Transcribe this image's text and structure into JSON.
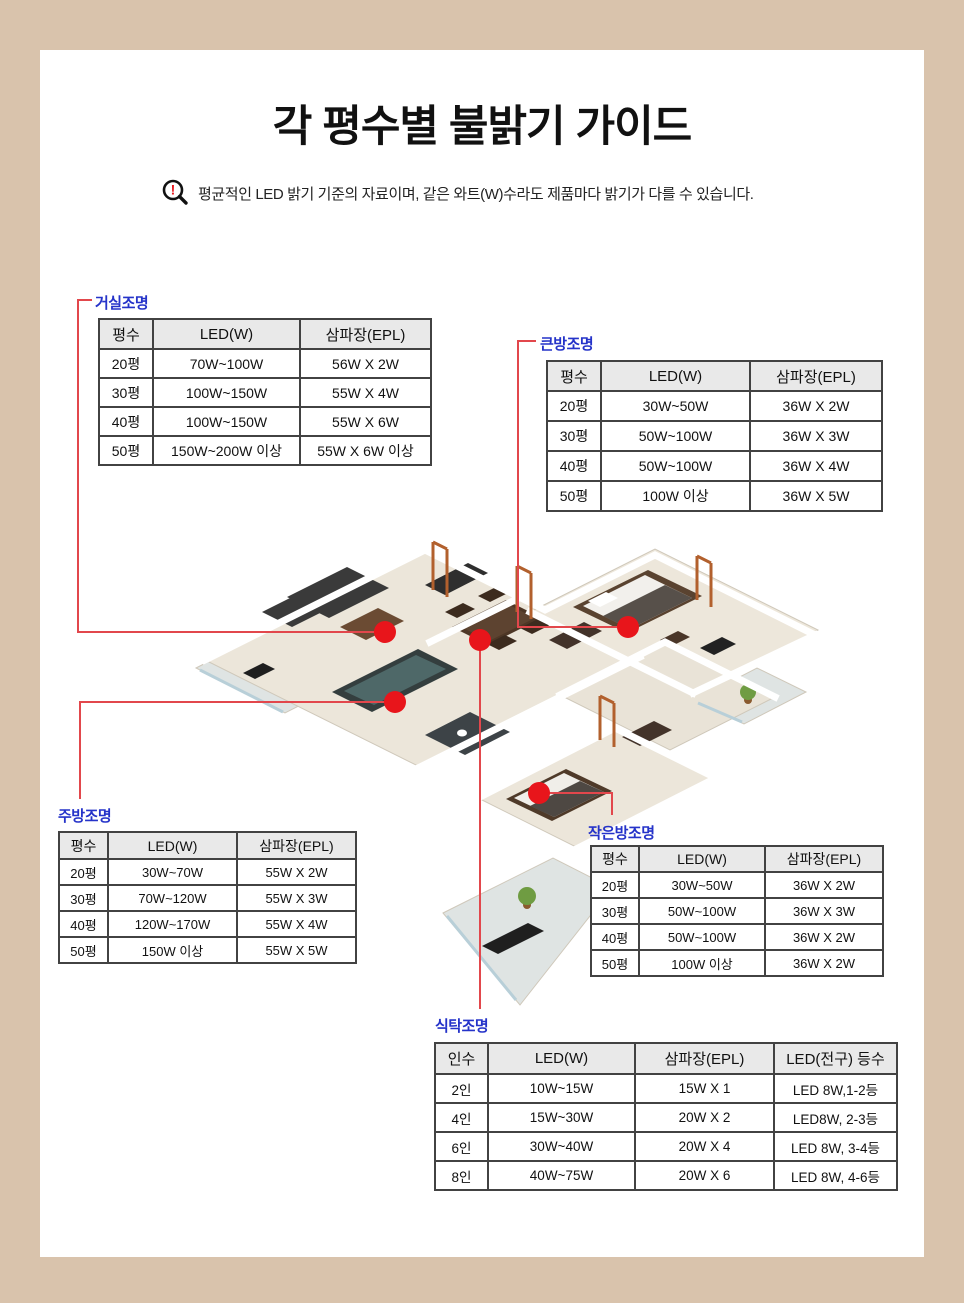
{
  "page": {
    "title": "각 평수별 불밝기 가이드",
    "notice": "평균적인 LED 밝기 기준의 자료이며, 같은 와트(W)수라도 제품마다 밝기가 다를 수 있습니다.",
    "colors": {
      "background_beige": "#d9c3ac",
      "panel_white": "#ffffff",
      "callout_blue": "#2533c9",
      "connector_red": "#e2474c",
      "dot_red": "#e8151b",
      "table_header_gray": "#e9e9e9",
      "table_border": "#424242"
    }
  },
  "icons": {
    "warning_magnifier": "magnifier-with-red-exclamation"
  },
  "floorplan": {
    "illustration": "3d-isometric-apartment-floorplan",
    "callouts": [
      {
        "room": "living",
        "label": "거실조명"
      },
      {
        "room": "bigroom",
        "label": "큰방조명"
      },
      {
        "room": "kitchen",
        "label": "주방조명"
      },
      {
        "room": "smallroom",
        "label": "작은방조명"
      },
      {
        "room": "dining",
        "label": "식탁조명"
      }
    ]
  },
  "tables": {
    "living": {
      "label": "거실조명",
      "headers": [
        "평수",
        "LED(W)",
        "삼파장(EPL)"
      ],
      "rows": [
        [
          "20평",
          "70W~100W",
          "56W X 2W"
        ],
        [
          "30평",
          "100W~150W",
          "55W X 4W"
        ],
        [
          "40평",
          "100W~150W",
          "55W X 6W"
        ],
        [
          "50평",
          "150W~200W 이상",
          "55W X 6W 이상"
        ]
      ]
    },
    "bigroom": {
      "label": "큰방조명",
      "headers": [
        "평수",
        "LED(W)",
        "삼파장(EPL)"
      ],
      "rows": [
        [
          "20평",
          "30W~50W",
          "36W X 2W"
        ],
        [
          "30평",
          "50W~100W",
          "36W X 3W"
        ],
        [
          "40평",
          "50W~100W",
          "36W X 4W"
        ],
        [
          "50평",
          "100W 이상",
          "36W X 5W"
        ]
      ]
    },
    "kitchen": {
      "label": "주방조명",
      "headers": [
        "평수",
        "LED(W)",
        "삼파장(EPL)"
      ],
      "rows": [
        [
          "20평",
          "30W~70W",
          "55W X 2W"
        ],
        [
          "30평",
          "70W~120W",
          "55W X 3W"
        ],
        [
          "40평",
          "120W~170W",
          "55W X 4W"
        ],
        [
          "50평",
          "150W 이상",
          "55W X 5W"
        ]
      ]
    },
    "smallroom": {
      "label": "작은방조명",
      "headers": [
        "평수",
        "LED(W)",
        "삼파장(EPL)"
      ],
      "rows": [
        [
          "20평",
          "30W~50W",
          "36W X 2W"
        ],
        [
          "30평",
          "50W~100W",
          "36W X 3W"
        ],
        [
          "40평",
          "50W~100W",
          "36W X 2W"
        ],
        [
          "50평",
          "100W 이상",
          "36W X 2W"
        ]
      ]
    },
    "dining": {
      "label": "식탁조명",
      "headers": [
        "인수",
        "LED(W)",
        "삼파장(EPL)",
        "LED(전구) 등수"
      ],
      "rows": [
        [
          "2인",
          "10W~15W",
          "15W X 1",
          "LED 8W,1-2등"
        ],
        [
          "4인",
          "15W~30W",
          "20W X 2",
          "LED8W, 2-3등"
        ],
        [
          "6인",
          "30W~40W",
          "20W X 4",
          "LED 8W, 3-4등"
        ],
        [
          "8인",
          "40W~75W",
          "20W X 6",
          "LED 8W, 4-6등"
        ]
      ]
    }
  }
}
